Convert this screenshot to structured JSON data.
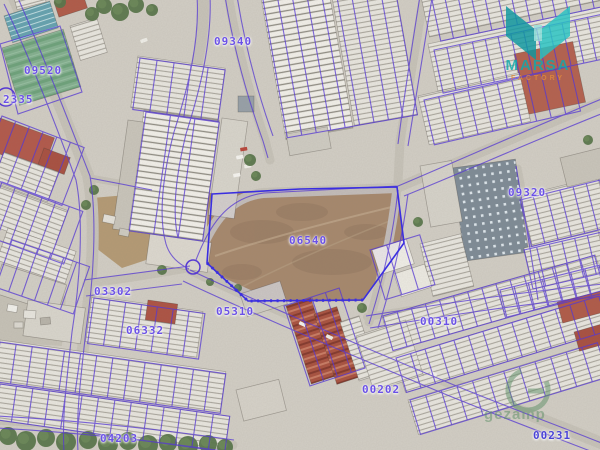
{
  "map": {
    "parcel_labels": [
      {
        "text": "09340",
        "x": 214,
        "y": 35
      },
      {
        "text": "09520",
        "x": 24,
        "y": 64
      },
      {
        "text": "2335",
        "x": 3,
        "y": 93
      },
      {
        "text": "09320",
        "x": 508,
        "y": 186
      },
      {
        "text": "06540",
        "x": 289,
        "y": 234
      },
      {
        "text": "03302",
        "x": 94,
        "y": 285
      },
      {
        "text": "05310",
        "x": 216,
        "y": 305
      },
      {
        "text": "00310",
        "x": 420,
        "y": 315
      },
      {
        "text": "06332",
        "x": 126,
        "y": 324
      },
      {
        "text": "00202",
        "x": 362,
        "y": 383
      },
      {
        "text": "04203",
        "x": 100,
        "y": 432
      },
      {
        "text": "00231",
        "x": 533,
        "y": 429,
        "c": "#4a43d6"
      }
    ],
    "overlay_color": "#5639d2",
    "label_color": "#6b51e6",
    "boundary_color": "#3a2ee0"
  },
  "branding": {
    "logo_text": "MARSA",
    "logo_subtext": "FACTORY",
    "logo_color": "#0fa9ad",
    "logo_subtext_color": "#e08a3c"
  },
  "watermark": {
    "text": "gezamp",
    "color": "#5d8f66"
  }
}
